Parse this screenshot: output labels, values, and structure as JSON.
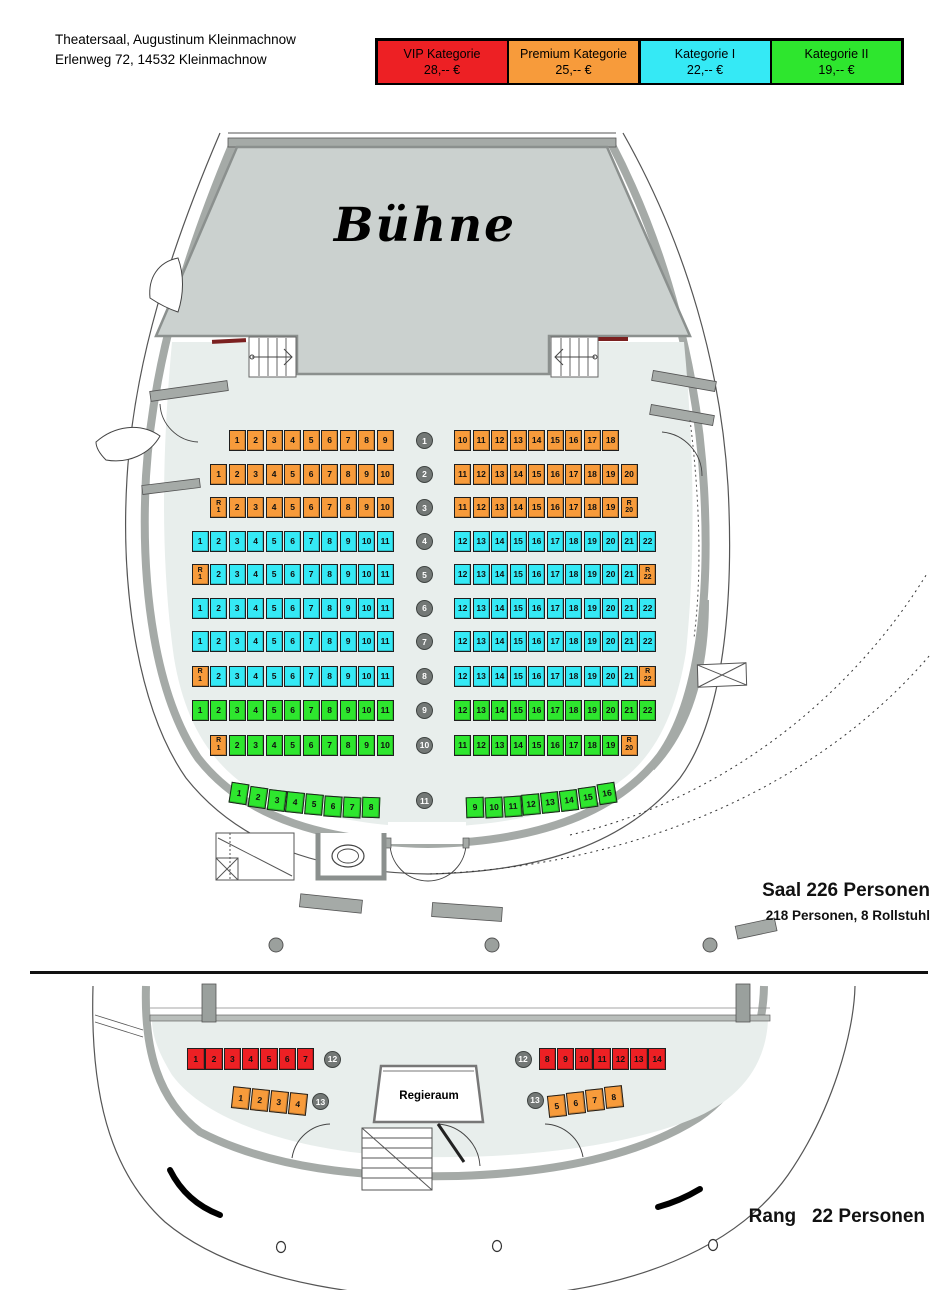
{
  "header": {
    "line1": "Theatersaal, Augustinum Kleinmachnow",
    "line2": "Erlenweg 72, 14532 Kleinmachnow"
  },
  "legend": {
    "items": [
      {
        "id": "vip",
        "label": "VIP Kategorie",
        "price": "28,-- €"
      },
      {
        "id": "premium",
        "label": "Premium Kategorie",
        "price": "25,-- €"
      },
      {
        "id": "kat1",
        "label": "Kategorie I",
        "price": "22,-- €"
      },
      {
        "id": "kat2",
        "label": "Kategorie II",
        "price": "19,-- €"
      }
    ]
  },
  "colors": {
    "vip": "#ED2024",
    "premium": "#F79B3B",
    "kat1": "#35E9F5",
    "kat2": "#2EE62E",
    "floor": "#e8eeec",
    "stage": "#cbd1cf",
    "wall": "#a5aaa7"
  },
  "stage_label": "Bühne",
  "hall": {
    "title": "Saal 226 Personen",
    "subtitle": "218 Personen, 8 Rollstuhl",
    "rows": [
      {
        "row": "1",
        "left": [
          "1|p",
          "2|p",
          "3|p",
          "4|p",
          "5|p",
          "6|p",
          "7|p",
          "8|p",
          "9|p"
        ],
        "right": [
          "10|p",
          "11|p",
          "12|p",
          "13|p",
          "14|p",
          "15|p",
          "16|p",
          "17|p",
          "18|p"
        ]
      },
      {
        "row": "2",
        "left": [
          "1|p",
          "2|p",
          "3|p",
          "4|p",
          "5|p",
          "6|p",
          "7|p",
          "8|p",
          "9|p",
          "10|p"
        ],
        "right": [
          "11|p",
          "12|p",
          "13|p",
          "14|p",
          "15|p",
          "16|p",
          "17|p",
          "18|p",
          "19|p",
          "20|p"
        ]
      },
      {
        "row": "3",
        "left": [
          "R1|p|r",
          "2|p",
          "3|p",
          "4|p",
          "5|p",
          "6|p",
          "7|p",
          "8|p",
          "9|p",
          "10|p"
        ],
        "right": [
          "11|p",
          "12|p",
          "13|p",
          "14|p",
          "15|p",
          "16|p",
          "17|p",
          "18|p",
          "19|p",
          "R20|p|r"
        ]
      },
      {
        "row": "4",
        "left": [
          "1|1",
          "2|1",
          "3|1",
          "4|1",
          "5|1",
          "6|1",
          "7|1",
          "8|1",
          "9|1",
          "10|1",
          "11|1"
        ],
        "right": [
          "12|1",
          "13|1",
          "14|1",
          "15|1",
          "16|1",
          "17|1",
          "18|1",
          "19|1",
          "20|1",
          "21|1",
          "22|1"
        ]
      },
      {
        "row": "5",
        "left": [
          "R1|p|r",
          "2|1",
          "3|1",
          "4|1",
          "5|1",
          "6|1",
          "7|1",
          "8|1",
          "9|1",
          "10|1",
          "11|1"
        ],
        "right": [
          "12|1",
          "13|1",
          "14|1",
          "15|1",
          "16|1",
          "17|1",
          "18|1",
          "19|1",
          "20|1",
          "21|1",
          "R22|p|r"
        ]
      },
      {
        "row": "6",
        "left": [
          "1|1",
          "2|1",
          "3|1",
          "4|1",
          "5|1",
          "6|1",
          "7|1",
          "8|1",
          "9|1",
          "10|1",
          "11|1"
        ],
        "right": [
          "12|1",
          "13|1",
          "14|1",
          "15|1",
          "16|1",
          "17|1",
          "18|1",
          "19|1",
          "20|1",
          "21|1",
          "22|1"
        ]
      },
      {
        "row": "7",
        "left": [
          "1|1",
          "2|1",
          "3|1",
          "4|1",
          "5|1",
          "6|1",
          "7|1",
          "8|1",
          "9|1",
          "10|1",
          "11|1"
        ],
        "right": [
          "12|1",
          "13|1",
          "14|1",
          "15|1",
          "16|1",
          "17|1",
          "18|1",
          "19|1",
          "20|1",
          "21|1",
          "22|1"
        ]
      },
      {
        "row": "8",
        "left": [
          "R1|p|r",
          "2|1",
          "3|1",
          "4|1",
          "5|1",
          "6|1",
          "7|1",
          "8|1",
          "9|1",
          "10|1",
          "11|1"
        ],
        "right": [
          "12|1",
          "13|1",
          "14|1",
          "15|1",
          "16|1",
          "17|1",
          "18|1",
          "19|1",
          "20|1",
          "21|1",
          "R22|p|r"
        ]
      },
      {
        "row": "9",
        "left": [
          "1|2",
          "2|2",
          "3|2",
          "4|2",
          "5|2",
          "6|2",
          "7|2",
          "8|2",
          "9|2",
          "10|2",
          "11|2"
        ],
        "right": [
          "12|2",
          "13|2",
          "14|2",
          "15|2",
          "16|2",
          "17|2",
          "18|2",
          "19|2",
          "20|2",
          "21|2",
          "22|2"
        ]
      },
      {
        "row": "10",
        "left": [
          "R1|p|r",
          "2|2",
          "3|2",
          "4|2",
          "5|2",
          "6|2",
          "7|2",
          "8|2",
          "9|2",
          "10|2"
        ],
        "right": [
          "11|2",
          "12|2",
          "13|2",
          "14|2",
          "15|2",
          "16|2",
          "17|2",
          "18|2",
          "19|2",
          "R20|p|r"
        ]
      },
      {
        "row": "11",
        "left": [
          "1|2",
          "2|2",
          "3|2",
          "4|2",
          "5|2",
          "6|2",
          "7|2",
          "8|2"
        ],
        "right": [
          "9|2",
          "10|2",
          "11|2",
          "12|2",
          "13|2",
          "14|2",
          "15|2",
          "16|2"
        ]
      }
    ]
  },
  "rang": {
    "title": "Rang   22 Personen",
    "regieraum": "Regieraum",
    "rows": [
      {
        "row": "12",
        "left": [
          "1|v",
          "2|v",
          "3|v",
          "4|v",
          "5|v",
          "6|v",
          "7|v"
        ],
        "right": [
          "8|v",
          "9|v",
          "10|v",
          "11|v",
          "12|v",
          "13|v",
          "14|v"
        ]
      },
      {
        "row": "13",
        "left": [
          "1|p",
          "2|p",
          "3|p",
          "4|p"
        ],
        "right": [
          "5|p",
          "6|p",
          "7|p",
          "8|p"
        ]
      }
    ]
  }
}
